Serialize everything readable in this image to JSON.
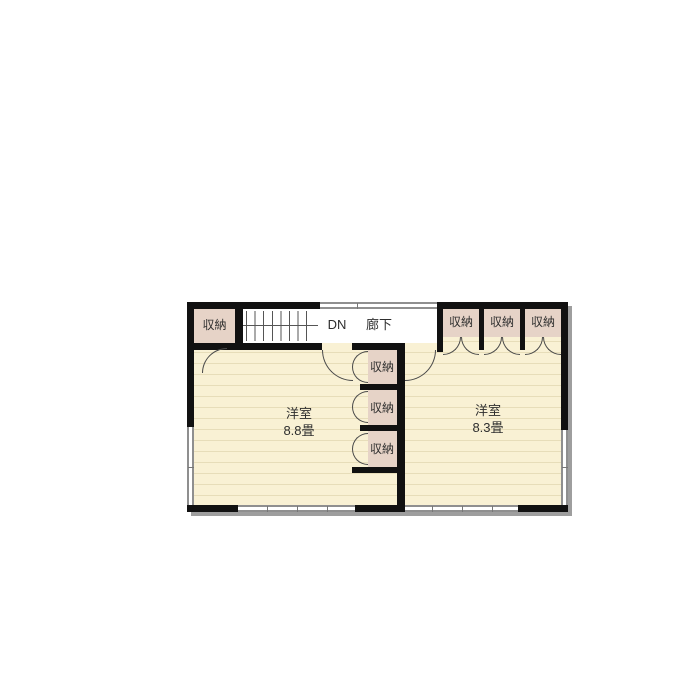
{
  "floorplan": {
    "corridor_label": "廊下",
    "stairs_label": "DN",
    "rooms": [
      {
        "name": "洋室",
        "size": "8.8畳"
      },
      {
        "name": "洋室",
        "size": "8.3畳"
      }
    ],
    "closet_labels": {
      "top_left": "収納",
      "middle": [
        "収納",
        "収納",
        "収納"
      ],
      "top_right": [
        "収納",
        "収納",
        "収納"
      ]
    },
    "colors": {
      "floor": "#f9f1d4",
      "floor_line": "#e7ddb9",
      "closet": "#e6d3c7",
      "corridor_floor": "#ffffff",
      "wall": "#111111",
      "window": "#8f8f8f",
      "door_arc": "#4a4a4a",
      "shadow": "#9e9e9e",
      "text": "#2e2e2e"
    }
  }
}
